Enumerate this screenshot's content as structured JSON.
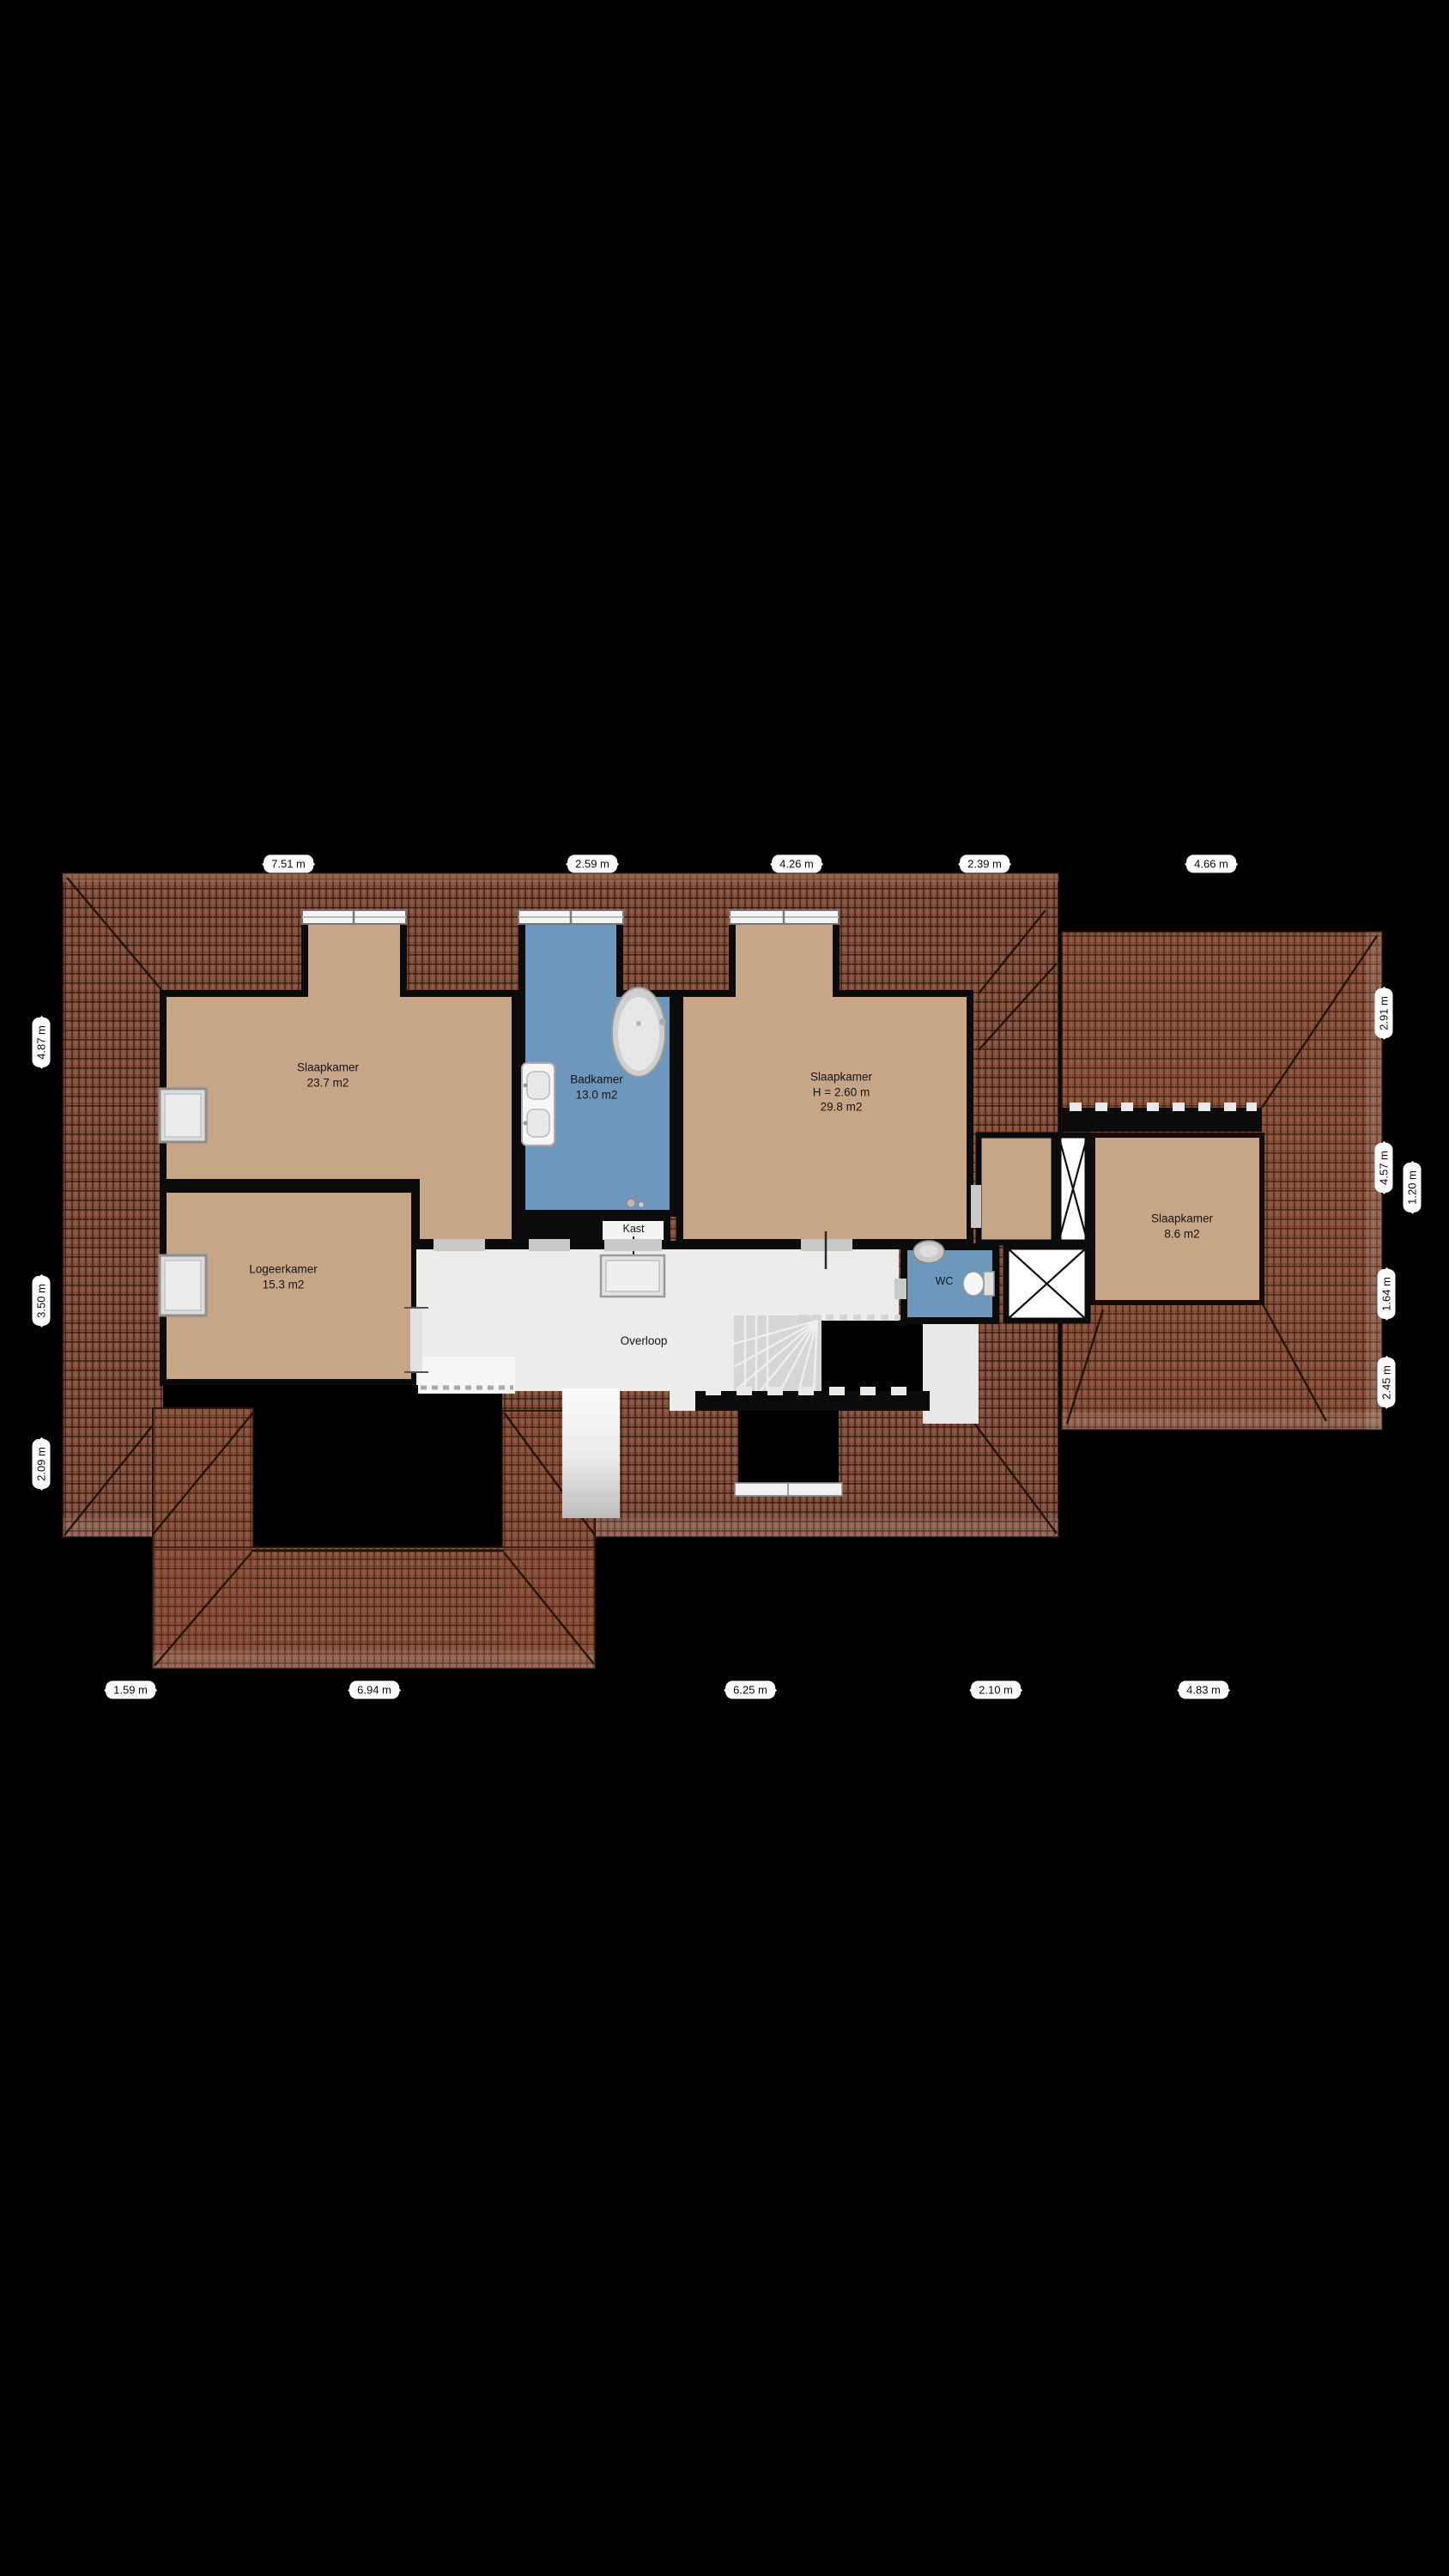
{
  "floorplan": {
    "type": "floor-plan",
    "language": "nl",
    "rooms": [
      {
        "id": "slaapkamer-1",
        "name": "Slaapkamer",
        "area": "23.7 m2"
      },
      {
        "id": "badkamer",
        "name": "Badkamer",
        "area": "13.0 m2"
      },
      {
        "id": "slaapkamer-2",
        "name": "Slaapkamer",
        "height": "H = 2.60 m",
        "area": "29.8 m2"
      },
      {
        "id": "slaapkamer-3",
        "name": "Slaapkamer",
        "area": "8.6 m2"
      },
      {
        "id": "logeerkamer",
        "name": "Logeerkamer",
        "area": "15.3 m2"
      },
      {
        "id": "kast",
        "name": "Kast"
      },
      {
        "id": "wc",
        "name": "WC"
      },
      {
        "id": "overloop",
        "name": "Overloop"
      }
    ],
    "dimensions": {
      "top": [
        "7.51 m",
        "2.59 m",
        "4.26 m",
        "2.39 m",
        "4.66 m"
      ],
      "left": [
        "4.87 m",
        "3.50 m",
        "2.09 m"
      ],
      "right": [
        "2.91 m",
        "4.57 m",
        "1.20 m",
        "1.64 m",
        "2.45 m"
      ],
      "bottom": [
        "1.59 m",
        "6.94 m",
        "6.25 m",
        "2.10 m",
        "4.83 m"
      ]
    },
    "colors": {
      "background": "#000000",
      "roof": "#8a5341",
      "floor_tan": "#c7a687",
      "floor_blue": "#6d97bd",
      "floor_gray": "#ececea",
      "wall": "#0b0b0b",
      "dimension_pill": "#ffffff"
    }
  }
}
